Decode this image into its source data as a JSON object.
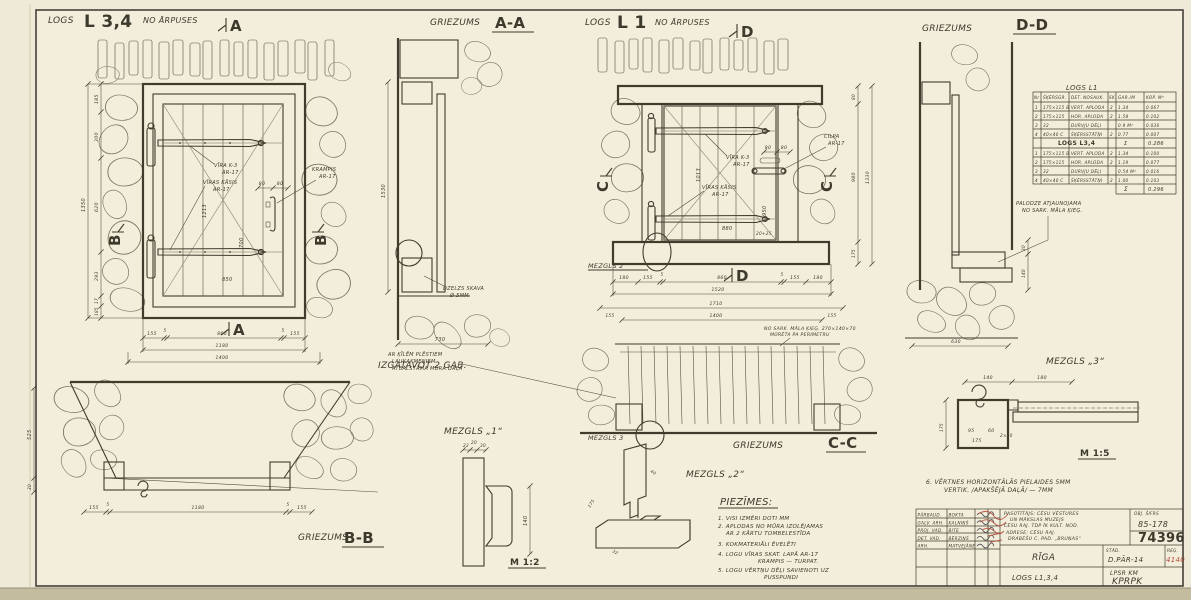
{
  "titles": {
    "logs": "LOGS",
    "l34": "L 3,4",
    "no_arpuses": "NO ĀRPUSES",
    "griezums": "GRIEZUMS",
    "aa": "A-A",
    "l1": "L 1",
    "dd": "D-D",
    "bb": "B-B",
    "cc": "C-C",
    "izgatavot": "IZGATAVOT 2 GAB.",
    "mezgls1_label": "MEZGLS „1“",
    "mezgls2_label": "MEZGLS „2“",
    "mezgls3_label": "MEZGLS „3“",
    "mezgls2_callout": "MEZGLS 2",
    "mezgls3_callout": "MEZGLS 3",
    "scale12": "M 1:2",
    "scale15": "M 1:5",
    "ma": "A",
    "mb": "B",
    "mc": "C",
    "md": "D"
  },
  "dims": {
    "l34": {
      "left": [
        "185",
        "300",
        "620",
        "293",
        "17",
        "185"
      ],
      "left_total": "1350",
      "bottom": [
        "155",
        "5",
        "860",
        "5",
        "155"
      ],
      "bottom_total": "1180",
      "grand_total": "1400",
      "board_h": "1213",
      "mid_h": "700",
      "mid_w": "850",
      "handle": [
        "80",
        "80"
      ]
    },
    "aa": {
      "height": "1530",
      "width": "730"
    },
    "l1": {
      "bottom": [
        "180",
        "155",
        "5",
        "860",
        "5",
        "155",
        "180"
      ],
      "bottom_total": "1520",
      "row2_total": "1710",
      "row3_total": "1400",
      "row3_sides": [
        "155",
        "155"
      ],
      "board_h": "1013",
      "mid_h": "950",
      "mid_w": "880",
      "small": "20+25",
      "handle": [
        "80",
        "80"
      ],
      "right": [
        "80",
        "980",
        "175"
      ],
      "right_total": "1330"
    },
    "dd": {
      "v1": "30",
      "v2": "140",
      "bottom": "630"
    },
    "bb": {
      "left": "525",
      "left2": "30",
      "bottom": [
        "155",
        "5",
        "1180",
        "5",
        "155"
      ]
    },
    "m1": {
      "top": [
        "22",
        "20",
        "30"
      ],
      "height": "140"
    },
    "m2": {
      "a": "175",
      "b": "40",
      "c": "32"
    },
    "m3": {
      "top": [
        "140",
        "180"
      ],
      "inner": [
        "95",
        "60",
        "2×30",
        "175"
      ],
      "left": "175"
    }
  },
  "ann": {
    "vira": "VĪRA K-3",
    "viras_kasis": "VĪRAS KĀSIS",
    "krampis": "KRAMPIS",
    "cilpa": "CILPA",
    "ar17": "AR-17",
    "skava1": "DZELZS SKAVA",
    "skava2": "Ø 5MM",
    "palodze1": "PALODZE ATJAUNOJAMA",
    "palodze2": "NO SARK. MĀLA ĶIEĢ.",
    "cc_left": [
      "AR ĶĪLĒM PLĒSTIEM",
      "LAUKAKMEŅIEM",
      "ATBALSTĀMA MŪRA DAĻA"
    ],
    "cc_right": [
      "NO SARK. MĀLA ĶIEĢ. 270×140×70",
      "MŪRĒTA PA PERIMETRU"
    ]
  },
  "table": {
    "title": "LOGS L1",
    "headers": [
      "Nr",
      "ŠĶĒRSGR.",
      "DET. NOSAUK.",
      "SK.",
      "GAR./M",
      "KOP. M³"
    ],
    "l1_rows": [
      [
        "1",
        "175×115 B",
        "VERT. APLODA",
        "2",
        "1.34",
        "0.067"
      ],
      [
        "2",
        "175×115",
        "HOR. APLODA",
        "2",
        "1.58",
        "0.102"
      ],
      [
        "3",
        "32",
        "DURVJU DĒĻI",
        "",
        "0.9 M²",
        "0.036"
      ],
      [
        "4",
        "40×40 C",
        "ŠĶĒRSSTĀTŅI",
        "2",
        "0.77",
        "0.007"
      ]
    ],
    "l34_title": "LOGS L3,4",
    "sum1_sym": "Σ",
    "sum1": "0.286",
    "l34_rows": [
      [
        "1",
        "175×115 B",
        "VERT. APLODA",
        "2",
        "1.34",
        "0.100"
      ],
      [
        "2",
        "175×115",
        "HOR. APLODA",
        "2",
        "1.19",
        "0.077"
      ],
      [
        "3",
        "32",
        "DURVJU DĒĻI",
        "",
        "0.54 M²",
        "0.016"
      ],
      [
        "4",
        "40×40 C",
        "ŠĶĒRSSTĀTŅI",
        "2",
        "1.00",
        "0.103"
      ]
    ],
    "sum2_sym": "Σ",
    "sum2": "0.296"
  },
  "notes": {
    "heading": "PIEZĪMES:",
    "lines": [
      "1. VISI IZMĒRI DOTI MM",
      "2. APLODAS NO MŪRA IZOLĒJAMAS",
      "AR 2 KĀRTU TOMBELESTĪDA",
      "3. KOKMATERIĀLI ĒVELĒTI",
      "4. LOGU VĪRAS SKAT. LAPĀ AR-17",
      "KRAMPIS — TURPAT.",
      "5. LOGU VĒRTŅU DĒĻI SAVIENOTI UZ",
      "PUSSPUNDI"
    ],
    "note6a": "6. VĒRTNES HORIZONTĀLĀS PIELAIDES 5MM",
    "note6b": "VERTIK. /APAKŠĒJĀ DAĻĀ/ — 7MM"
  },
  "titleblock": {
    "staff": [
      {
        "role": "PĀRBAUD.",
        "name": "BOKTA"
      },
      {
        "role": "GALV. ARH.",
        "name": "KALNIŅŠ"
      },
      {
        "role": "PROJ. VAD.",
        "name": "BITE"
      },
      {
        "role": "DET. VAD.",
        "name": "BĒRZIŅŠ"
      },
      {
        "role": "ARH.",
        "name": "MATVEJĀNE"
      }
    ],
    "client": [
      "PASŪTĪTĀJS: CĒSU VĒSTURES",
      "UN MĀKSLAS MUZEJS",
      "CĒSU RAJ. TDP ĪK KULT. NOD."
    ],
    "address": [
      "ADRESE: CĒSU RAJ.",
      "DRABEŠU C. PAD. „BRUŅAS“"
    ],
    "obj_label": "OBJ. ŠIFRS",
    "obj_code": "85-178",
    "order_no": "74396",
    "city": "RĪGA",
    "stad_label": "STĀD.",
    "stad_value": "D.PĀR-14",
    "reg_label": "REĢ.",
    "reg_value": "4140",
    "subject": "LOGS L1,3,4",
    "org_line1": "LPSR KM",
    "org_line2": "KPRPK"
  }
}
